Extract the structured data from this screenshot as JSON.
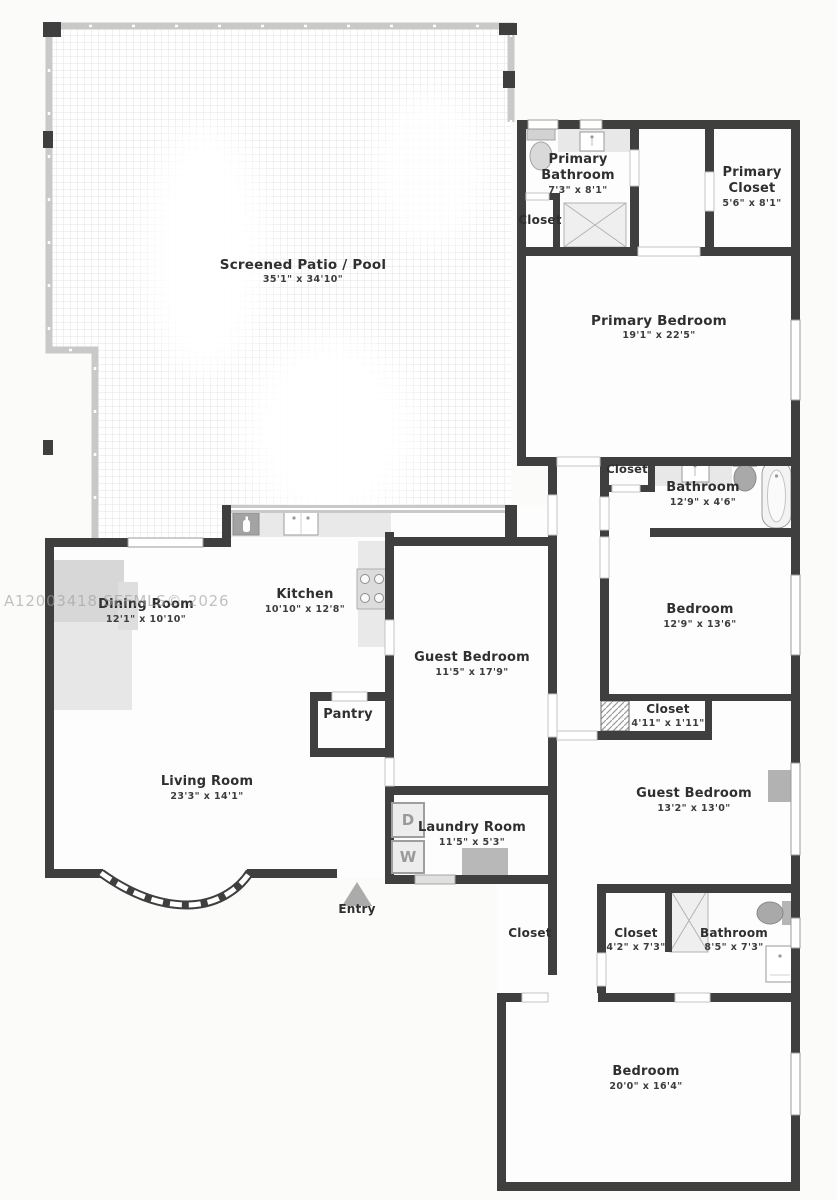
{
  "watermark": "A12003418  SEFMLS© 2026",
  "labels": {
    "patio": {
      "name": "Screened Patio / Pool",
      "dims": "35'1\" x 34'10\""
    },
    "primary_bathroom": {
      "name": "Primary Bathroom",
      "dims": "7'3\" x 8'1\""
    },
    "primary_bathroom_closet": {
      "name": "Closet"
    },
    "primary_closet": {
      "name": "Primary Closet",
      "dims": "5'6\" x 8'1\""
    },
    "primary_bedroom": {
      "name": "Primary Bedroom",
      "dims": "19'1\" x 22'5\""
    },
    "hall_closet": {
      "name": "Closet"
    },
    "hall_bathroom": {
      "name": "Bathroom",
      "dims": "12'9\" x 4'6\""
    },
    "middle_bedroom": {
      "name": "Bedroom",
      "dims": "12'9\" x 13'6\""
    },
    "middle_bedroom_closet": {
      "name": "Closet",
      "dims": "4'11\" x 1'11\""
    },
    "guest_bedroom_east": {
      "name": "Guest Bedroom",
      "dims": "13'2\" x 13'0\""
    },
    "dining_room": {
      "name": "Dining Room",
      "dims": "12'1\" x 10'10\""
    },
    "kitchen": {
      "name": "Kitchen",
      "dims": "10'10\" x 12'8\""
    },
    "guest_bedroom_center": {
      "name": "Guest Bedroom",
      "dims": "11'5\" x 17'9\""
    },
    "pantry": {
      "name": "Pantry"
    },
    "living_room": {
      "name": "Living Room",
      "dims": "23'3\" x 14'1\""
    },
    "laundry_room": {
      "name": "Laundry Room",
      "dims": "11'5\" x 5'3\""
    },
    "entry": {
      "name": "Entry"
    },
    "lower_hall_closet": {
      "name": "Closet"
    },
    "lower_closet": {
      "name": "Closet",
      "dims": "4'2\" x 7'3\""
    },
    "lower_bathroom": {
      "name": "Bathroom",
      "dims": "8'5\" x 7'3\""
    },
    "lower_bedroom": {
      "name": "Bedroom",
      "dims": "20'0\" x 16'4\""
    }
  },
  "appliances": {
    "dryer": "D",
    "washer": "W"
  },
  "colors": {
    "wall": "#3f3f3f",
    "room": "#fdfdfd",
    "screen": "#c9c9c9",
    "fixture": "#d9d9d9",
    "watermark": "#9e9e9e"
  }
}
